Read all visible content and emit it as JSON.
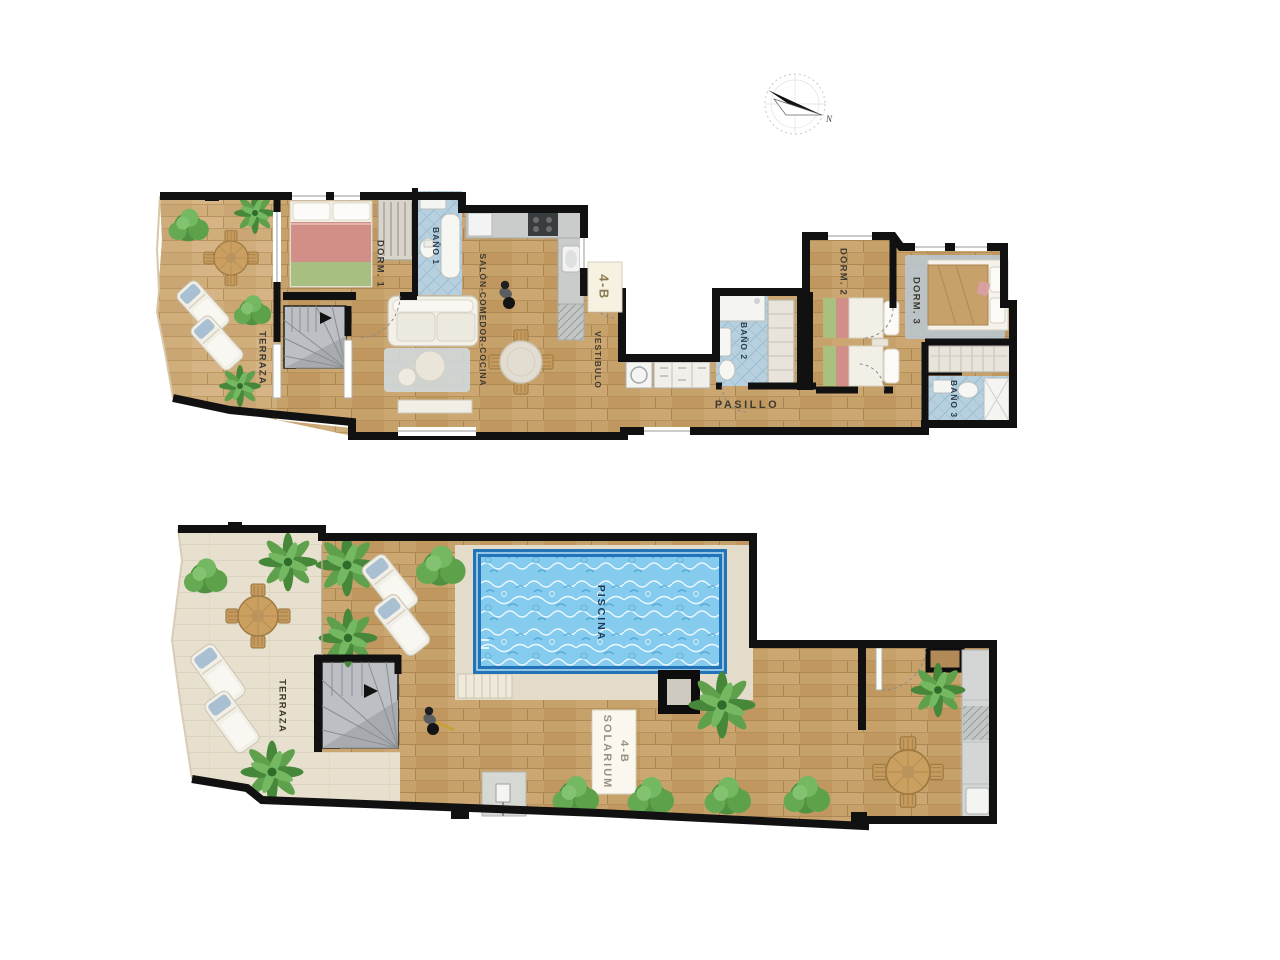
{
  "page": {
    "background": "#ffffff",
    "description": "Two-level apartment floor plan, unit 4-B, with solarium and pool"
  },
  "compass": {
    "north_label": "N"
  },
  "upper_floor": {
    "unit_plaque": "4-B",
    "rooms": {
      "terraza": "TERRAZA",
      "dorm1": "DORM. 1",
      "bano1": "BAÑO 1",
      "salon": "SALÓN-COMEDOR-COCINA",
      "vestibulo": "VESTIBULO",
      "pasillo": "PASILLO",
      "bano2": "BAÑO 2",
      "dorm2": "DORM. 2",
      "dorm3": "DORM. 3",
      "bano3": "BAÑO 3"
    }
  },
  "solarium_floor": {
    "rooms": {
      "terraza": "TERRAZA",
      "piscina": "PISCINA",
      "solarium": "SOLARIUM",
      "solarium_unit": "4-B"
    }
  },
  "colors": {
    "wall": "#111111",
    "wood_floor": "#c7a16a",
    "deck_floor": "#cba873",
    "terrace_floor": "#e8e0cf",
    "pool_water": "#85cbee",
    "pool_border": "#2373b9",
    "bath_tile": "#b6d0df",
    "stair_gray": "#bcbfc3",
    "kitchen_gray": "#c9cccb",
    "label_text": "#3e3a33",
    "bath_label_text": "#27384d",
    "plaque_text": "#8a7c52",
    "plant_green": "#4f9140"
  }
}
